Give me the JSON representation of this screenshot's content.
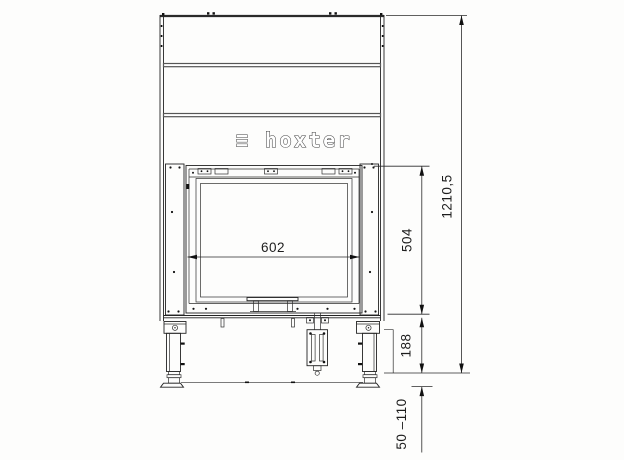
{
  "drawing": {
    "title": "fireplace-insert-front-view",
    "logo": "≡ hoxter",
    "line_color": "#232323",
    "band_color": "#565656",
    "dims": {
      "glass_width": "602",
      "firebox_height": "504",
      "base_height": "188",
      "total_height": "1210,5",
      "leg_adjust_range": "50 –110"
    }
  }
}
